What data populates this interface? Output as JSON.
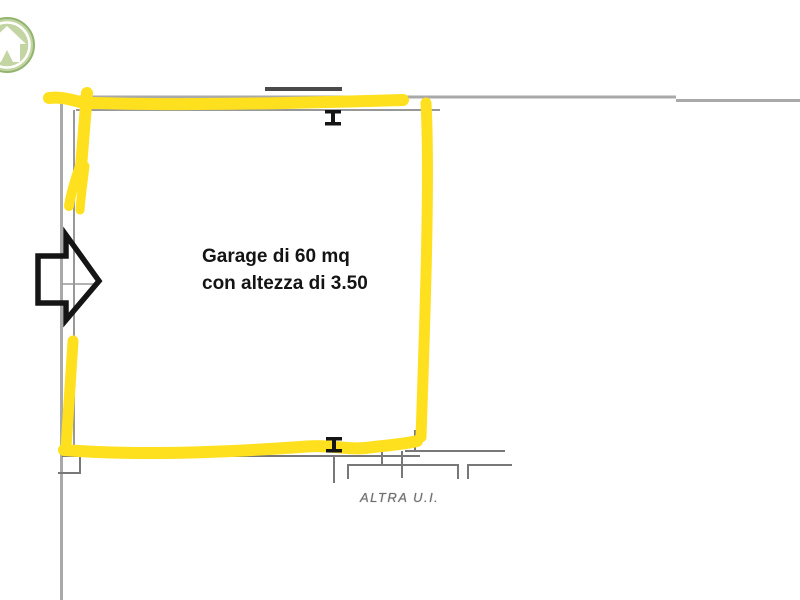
{
  "page": {
    "background": "#FFFFFF",
    "description_texts_visible": 3
  },
  "annotations": {
    "garage_label_line1": "Garage di 60 mq",
    "garage_label_line2": "con altezza di 3.50",
    "neighbor_unit_label": "ALTRA U.I."
  },
  "icons": {
    "logo": "home-logo-icon",
    "arrow": "right-arrow-icon",
    "beam_top": "steel-beam-icon",
    "beam_bottom": "steel-beam-icon"
  },
  "colors": {
    "highlight_yellow": "#FFE01E",
    "wall_gray": "#A9A9A9",
    "wall_gray_medium": "#989898",
    "wall_gray_dark": "#787878",
    "beam_dark": "#4A4A4A",
    "annotation_black": "#151515",
    "label_gray": "#6E6E6E",
    "logo_fill_green": "#C2D5A2",
    "logo_ring_green": "#93B470"
  }
}
